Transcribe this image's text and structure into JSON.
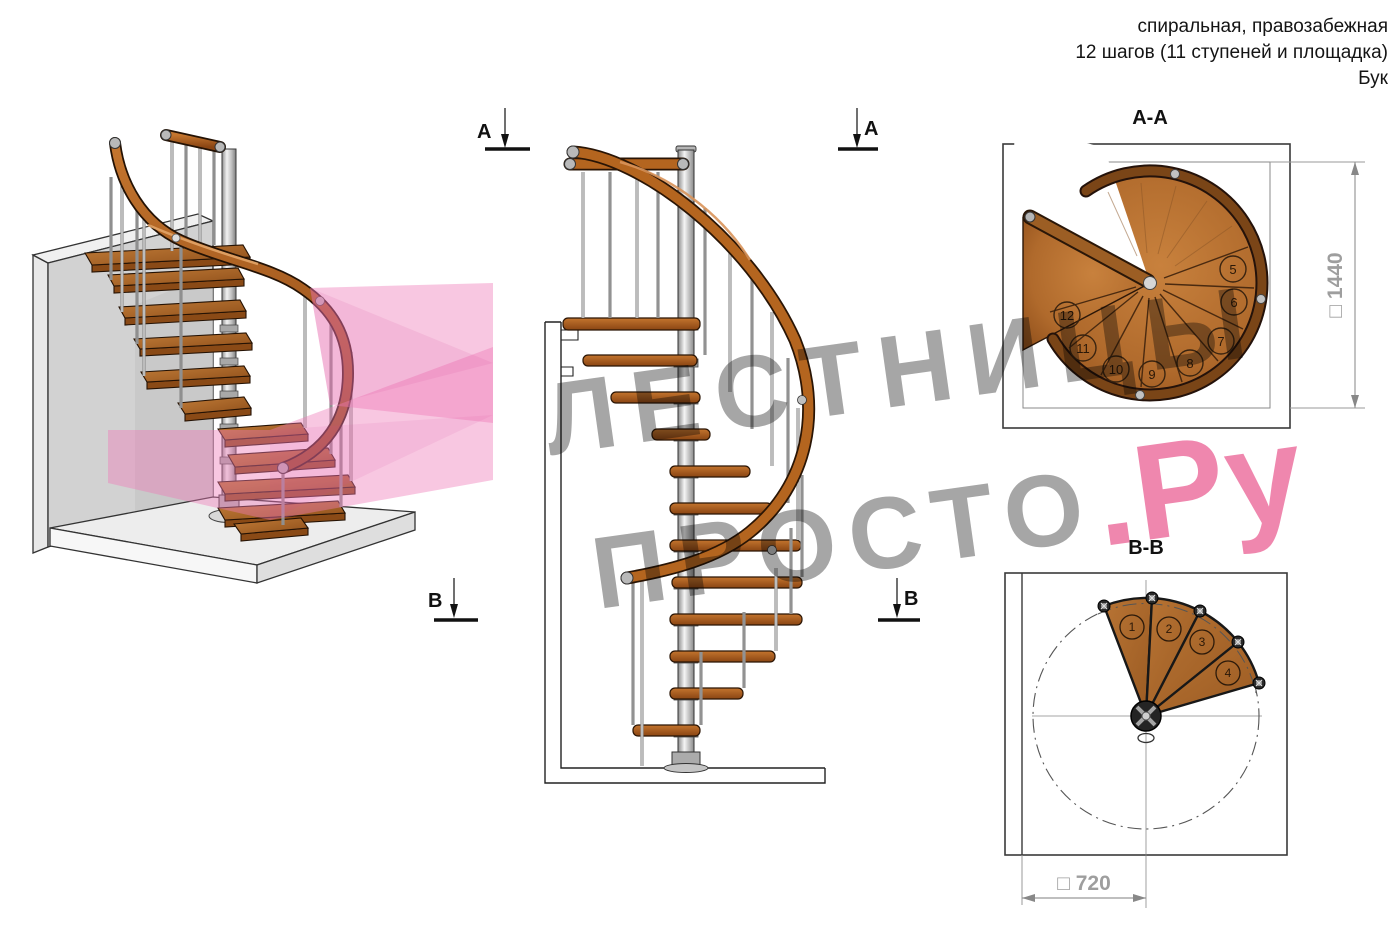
{
  "header": {
    "line1": "спиральная, правозабежная",
    "line2": "12 шагов (11 ступеней и площадка)",
    "line3": "Бук"
  },
  "watermark": {
    "line1": "ЛЕСТНИЦЫ",
    "line2_gray": "ПРОСТО",
    "line2_pink": ".Ру",
    "gray_color": "#a6a6a6",
    "pink_color": "#ef87ae"
  },
  "views": {
    "perspective": {
      "description": "3d-render-spiral-staircase"
    },
    "elevation": {
      "markers": {
        "a": "А",
        "b": "В"
      }
    },
    "aa": {
      "title": "А-А",
      "dimension": "□ 1440",
      "step_numbers": [
        "5",
        "6",
        "7",
        "8",
        "9",
        "10",
        "11",
        "12"
      ]
    },
    "bb": {
      "title": "В-В",
      "dimension": "□ 720",
      "step_numbers": [
        "1",
        "2",
        "3",
        "4"
      ]
    }
  },
  "colors": {
    "wood": "#b06a2c",
    "wood_dark": "#7a4012",
    "rail": "#b4651f",
    "metal": "#c9c9c9",
    "wall": "#d2d2d2",
    "pink_plane": "#ee79b8",
    "dim_text": "#9e9e9e"
  }
}
